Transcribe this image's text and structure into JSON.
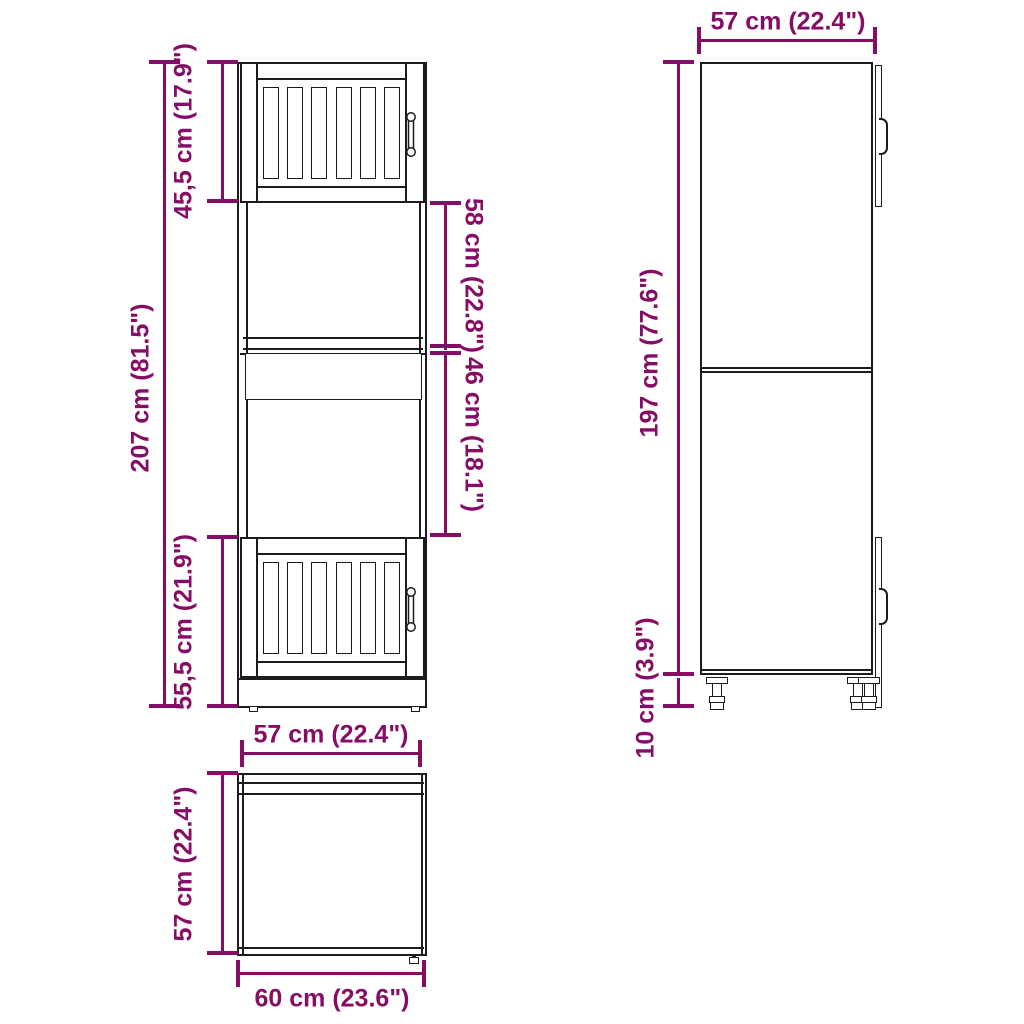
{
  "diagram": {
    "type": "furniture-dimension-diagram",
    "colors": {
      "dimension": "#860d66",
      "outline": "#1c1c1c",
      "background": "#ffffff"
    },
    "views": {
      "front": {
        "label": "front view",
        "dims": {
          "total_height": "207 cm (81.5\")",
          "top_door_height": "45,5 cm (17.9\")",
          "upper_niche_height": "58 cm (22.8\")",
          "lower_niche_height": "46 cm (18.1\")",
          "bottom_door_height": "55,5 cm (21.9\")",
          "width": "57 cm (22.4\")"
        }
      },
      "side": {
        "label": "side view",
        "dims": {
          "depth": "57 cm (22.4\")",
          "body_height": "197 cm (77.6\")",
          "feet_height": "10 cm (3.9\")"
        }
      },
      "top": {
        "label": "top view",
        "dims": {
          "depth": "57 cm (22.4\")",
          "total_width": "60 cm (23.6\")"
        }
      }
    }
  }
}
